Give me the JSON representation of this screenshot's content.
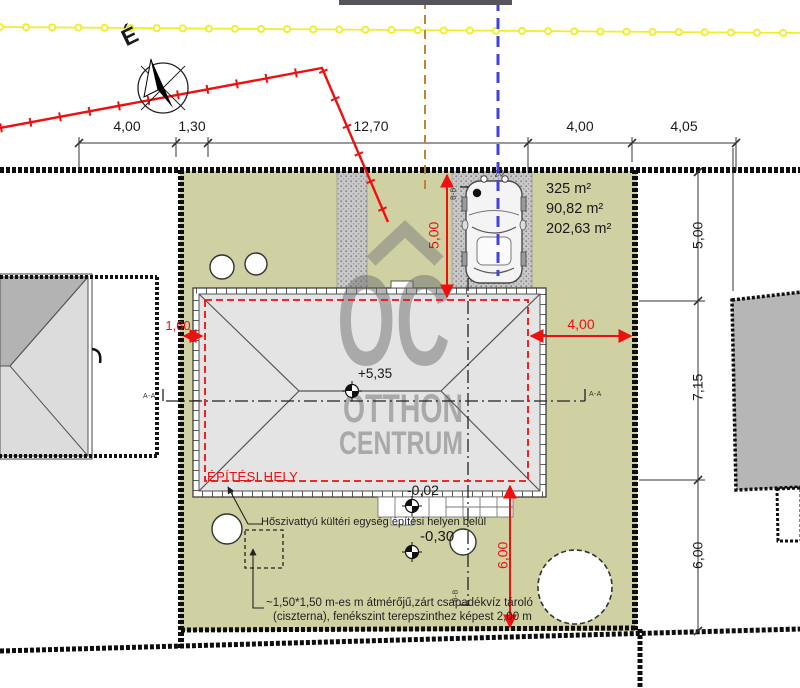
{
  "drawing": {
    "north_label": "É",
    "watermark": {
      "logo": "OC",
      "line2": "OTTHON",
      "line3": "CENTRUM"
    },
    "areas": {
      "plot": "325 m²",
      "building": "90,82 m²",
      "other": "202,63 m²"
    },
    "top_dimensions": [
      "4,00",
      "1,30",
      "12,70",
      "4,00",
      "4,05"
    ],
    "right_dimensions": [
      "5,00",
      "7,15",
      "6,00"
    ],
    "red_dimensions": {
      "left": "1,60",
      "right": "4,00",
      "top": "5,00",
      "bottom": "6,00"
    },
    "levels": {
      "roof": "+5,35",
      "terrace": "-0,02",
      "yard": "-0,30"
    },
    "building_site_label": "ÉPÍTÉSI HELY",
    "heat_pump_note": "Hőszivattyú kültéri egység építési helyen belül",
    "cistern_note_line1": "~1,50*1,50 m-es m átmérőjű,zárt csapadékvíz tároló",
    "cistern_note_line2": "(ciszterna), fenékszint terepszinthez képest 2,00 m",
    "section_labels": {
      "a": "A-A",
      "b": "B-B"
    },
    "misc": {
      "hood_number": "20"
    },
    "colors": {
      "parcel_green": "#cfd1a2",
      "dimension_red": "#ee0f0f",
      "utility_yellow": "#f0ee30",
      "utility_blue": "#4242dd",
      "utility_orange": "#bc8433",
      "roof_gray": "#e4e4e4",
      "neighbor_gray": "#b6b6b6",
      "watermark_gray": "#6f6f6f"
    }
  }
}
